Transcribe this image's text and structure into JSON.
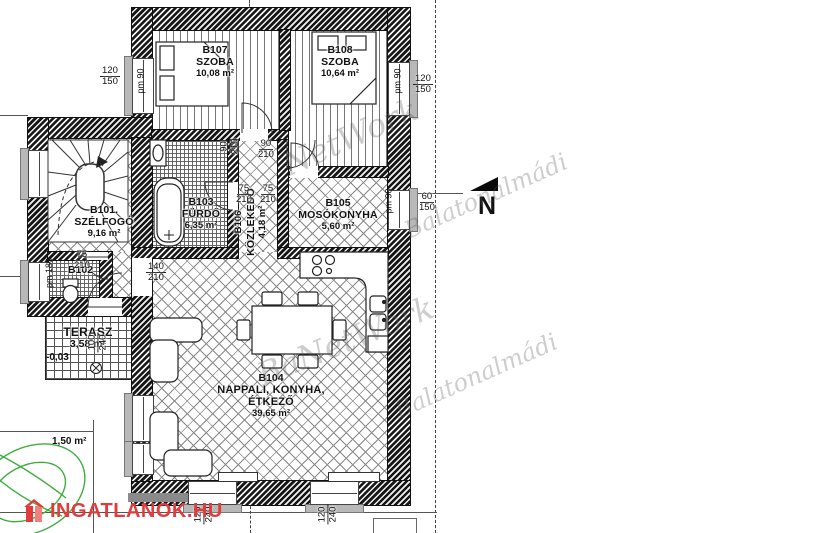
{
  "rooms": [
    {
      "id": "B107",
      "name": "SZOBA",
      "area": "10,08 m²"
    },
    {
      "id": "B108",
      "name": "SZOBA",
      "area": "10,64 m²"
    },
    {
      "id": "B103",
      "name": "FÜRDŐ",
      "area": "6,35 m²"
    },
    {
      "id": "B105",
      "name": "MOSÓKONYHA",
      "area": "5,60 m²"
    },
    {
      "id": "B106",
      "name": "KÖZLEKEDŐ",
      "area": "4,18 m²"
    },
    {
      "id": "B101.",
      "name": "SZÉLFOGÓ",
      "area": "9,16 m²"
    },
    {
      "id": "B102",
      "name": "",
      "area": ""
    },
    {
      "id": "B104",
      "name": "NAPPALI, KONYHA, ÉTKEZŐ",
      "area": "39,65 m²"
    }
  ],
  "outdoor": {
    "terrace_label": "TERASZ",
    "terrace_area": "3,58 m²",
    "terrace_level": "-0,03",
    "garden_area": "1,50 m²"
  },
  "dims": {
    "win_tl": {
      "a": "120",
      "b": "150"
    },
    "win_tr": {
      "a": "120",
      "b": "150"
    },
    "win_right": {
      "a": "60",
      "b": "150"
    },
    "door_hall_a": {
      "a": "90",
      "b": "210"
    },
    "door_hall_b": {
      "a": "90",
      "b": "210"
    },
    "door_bath": {
      "a": "75",
      "b": "210"
    },
    "door_corr": {
      "a": "75",
      "b": "210"
    },
    "door_kitchen": {
      "a": "140",
      "b": "210"
    },
    "door_wc": {
      "a": "75",
      "b": "210"
    },
    "door_entry": {
      "a": "100",
      "b": "240"
    },
    "door_terrace_l": {
      "a": "120",
      "b": "240"
    },
    "door_terrace_r": {
      "a": "120",
      "b": "240"
    },
    "pm_tl": "pm 90",
    "pm_tr": "pm 90",
    "pm_right": "pm 90",
    "pm_wc": "pm 180"
  },
  "north": {
    "label": "N"
  },
  "watermark": {
    "fragment": "NetWork",
    "name": "BaNetWork",
    "city": "Balatonalmádi"
  },
  "logo": {
    "text": "INGATLANOK.HU"
  },
  "colors": {
    "logo_red": "#e23b3b",
    "tree_green": "#3fae3f",
    "wall_dark": "#161616"
  }
}
